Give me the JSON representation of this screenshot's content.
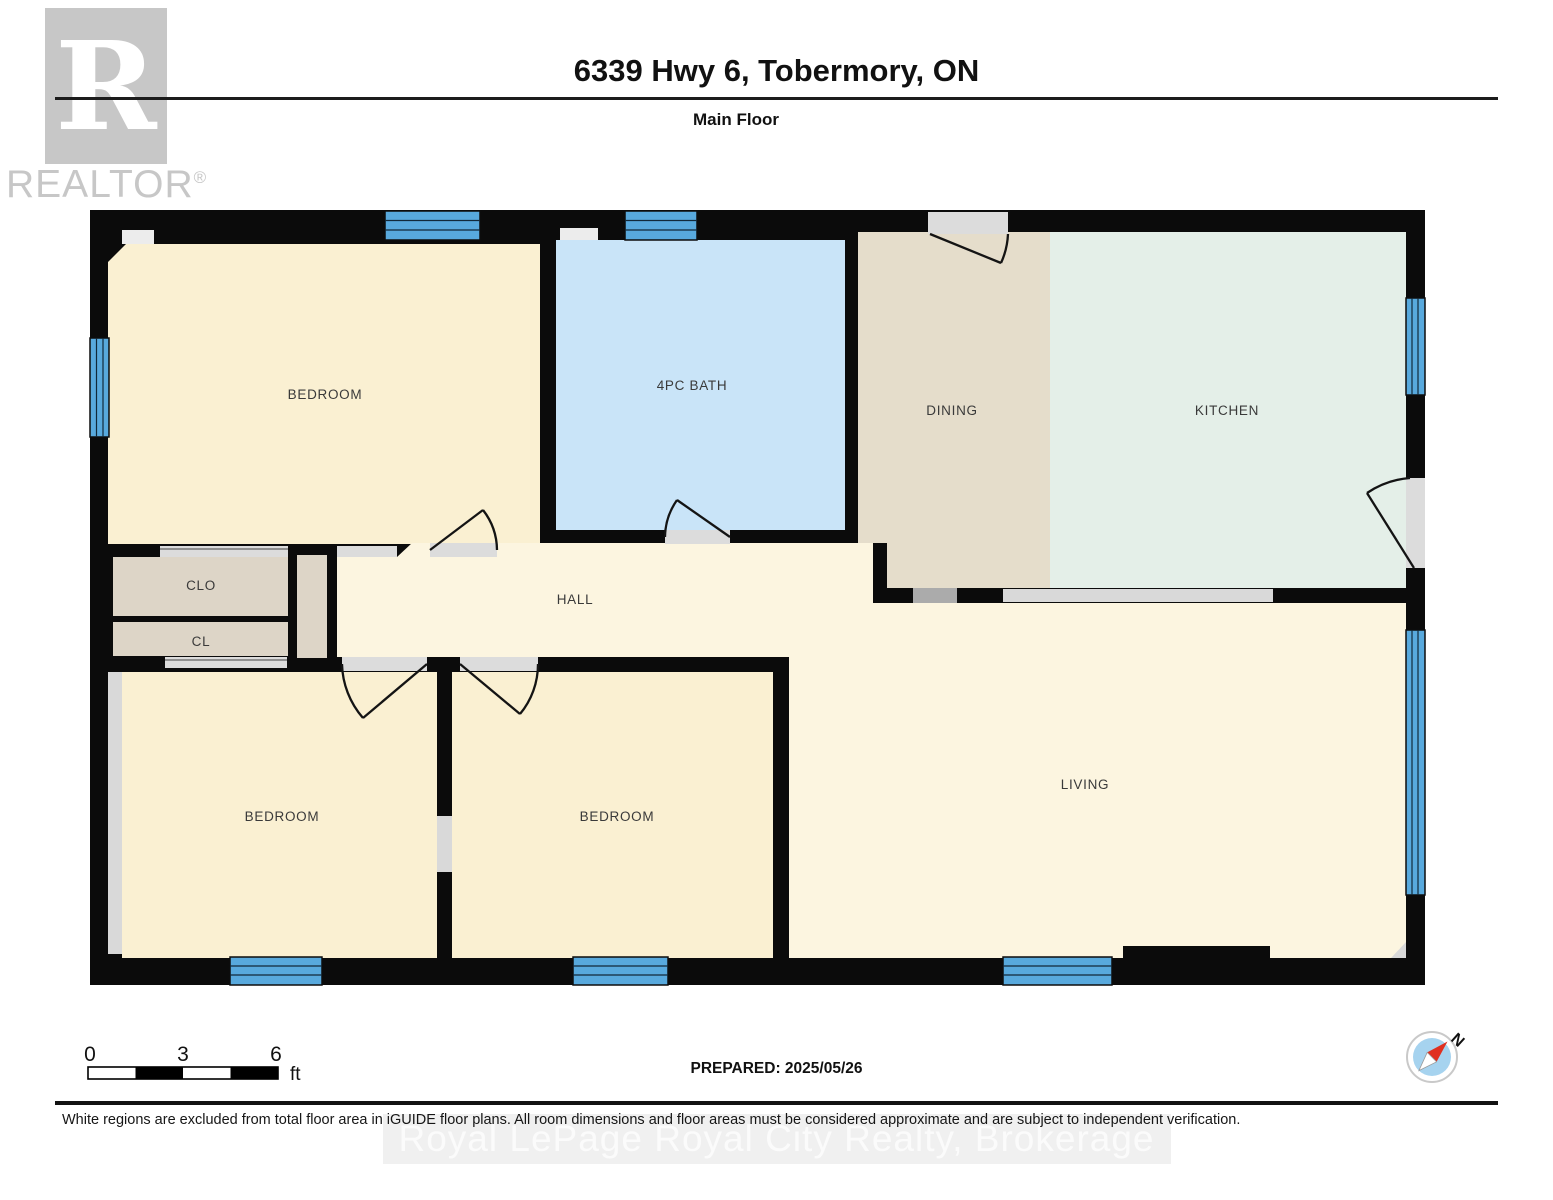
{
  "header": {
    "title": "6339 Hwy 6, Tobermory, ON",
    "floor_label": "Main Floor",
    "logo": {
      "letter": "R",
      "text": "REALTOR",
      "reg": "®"
    }
  },
  "plan": {
    "rooms": {
      "bedroom_tl": "BEDROOM",
      "bath": "4PC BATH",
      "dining": "DINING",
      "kitchen": "KITCHEN",
      "clo": "CLO",
      "cl": "CL",
      "hall": "HALL",
      "bedroom_bl": "BEDROOM",
      "bedroom_bm": "BEDROOM",
      "living": "LIVING"
    },
    "colors": {
      "wall": "#0b0b0b",
      "bedroom_fill": "#faf0d2",
      "hall_fill": "#fcf5e0",
      "living_fill": "#fcf5e0",
      "bath_fill": "#c9e4f8",
      "dining_fill": "#e5ddcb",
      "closet_fill": "#ddd5c7",
      "kitchen_fill": "#e4efe8",
      "window_blue": "#58a9dd",
      "door_gray": "#dcdcdc",
      "counter_gray": "#d9d9d9",
      "appliance_gray": "#ababab"
    }
  },
  "scale_bar": {
    "ticks": [
      "0",
      "3",
      "6"
    ],
    "unit": "ft"
  },
  "compass": {
    "north": "N"
  },
  "footer": {
    "prepared": "PREPARED: 2025/05/26",
    "disclaimer": "White regions are excluded from total floor area in iGUIDE floor plans. All room dimensions and floor areas must be considered approximate and are subject to independent verification.",
    "watermark": "Royal LePage Royal City Realty, Brokerage"
  }
}
